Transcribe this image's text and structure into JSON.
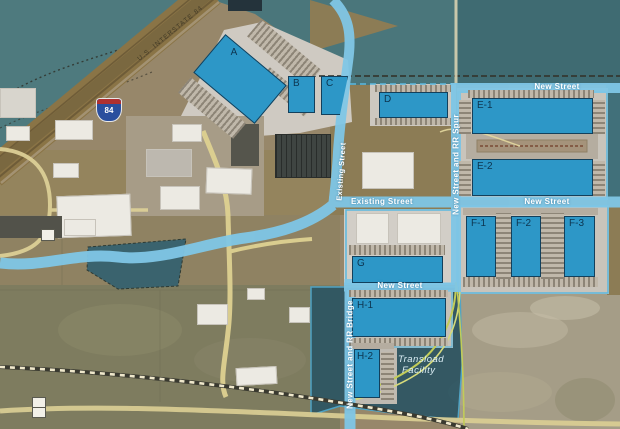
{
  "map": {
    "description": "Aerial site plan of an industrial development",
    "highway_label": "U.S. INTERSTATE 84",
    "interstate_shield_number": "84"
  },
  "roads": {
    "new_street": "New Street",
    "existing_street": "Existing Street",
    "rr_spur": "New Street and RR Spur",
    "rr_bridge": "New Street and RR Bridge"
  },
  "areas": {
    "transload_line1": "Transload",
    "transload_line2": "Facility"
  },
  "buildings": [
    {
      "id": "a",
      "label": "A"
    },
    {
      "id": "b",
      "label": "B"
    },
    {
      "id": "c",
      "label": "C"
    },
    {
      "id": "d",
      "label": "D"
    },
    {
      "id": "e1",
      "label": "E-1"
    },
    {
      "id": "e2",
      "label": "E-2"
    },
    {
      "id": "f1",
      "label": "F-1"
    },
    {
      "id": "f2",
      "label": "F-2"
    },
    {
      "id": "f3",
      "label": "F-3"
    },
    {
      "id": "g",
      "label": "G"
    },
    {
      "id": "h1",
      "label": "H-1"
    },
    {
      "id": "h2",
      "label": "H-2"
    }
  ],
  "icons": {
    "interstate_shield": "interstate-84-shield",
    "route_marker": "small-route-marker-shield"
  },
  "colors": {
    "planned_building": "#2D97C7",
    "building_border": "#13405C",
    "building_label_text": "#0D3550",
    "road_overlay_blue": "#7FC6E6",
    "water_dark": "#3F6B72",
    "water_light": "#4E7A7E",
    "transload_area": "#2C5563",
    "terrain_tan": "#97876A",
    "rail_spur_green": "#C2CC58",
    "road_yellow": "#DED191",
    "dock_apron_gray": "#B5ADA0"
  }
}
